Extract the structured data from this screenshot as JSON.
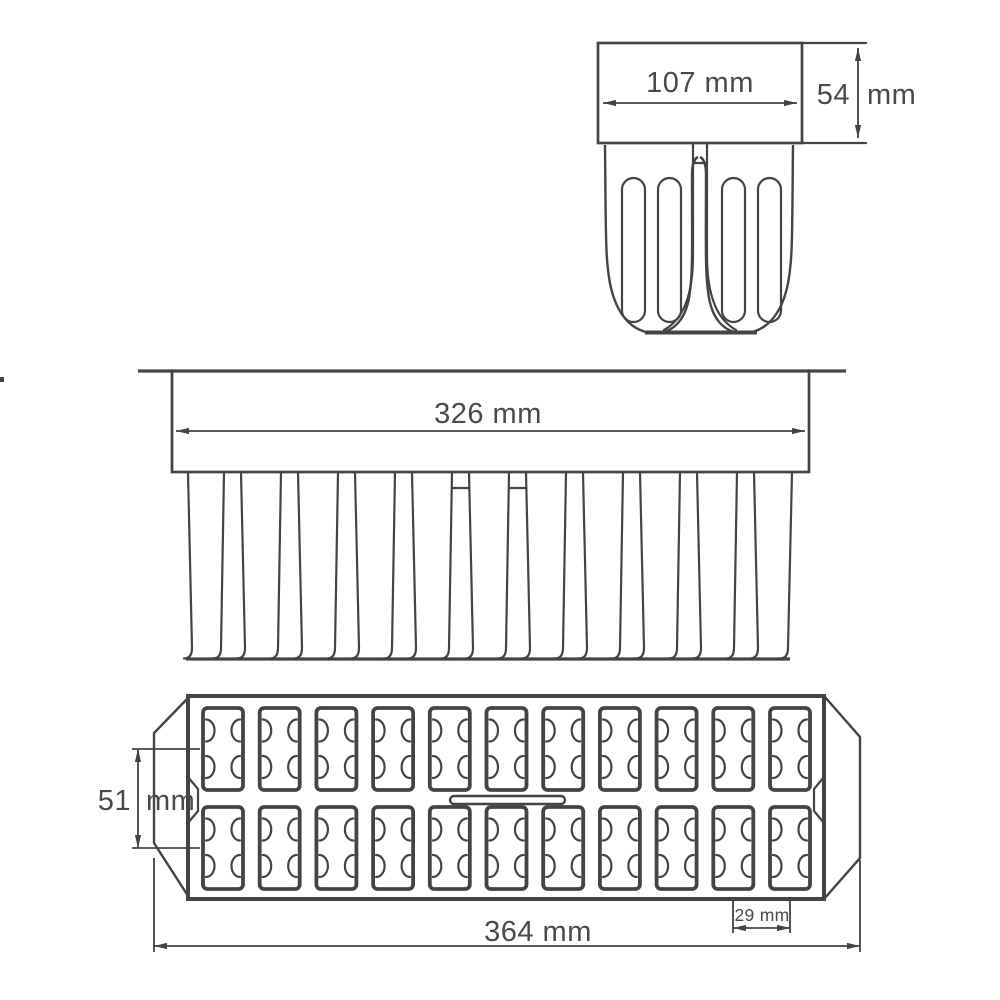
{
  "colors": {
    "line": "#444444",
    "text": "#4a4a4a",
    "background": "#ffffff"
  },
  "views": {
    "side": {
      "width_dim": "107 mm",
      "height_dim_value": "54",
      "height_dim_unit": "mm"
    },
    "front": {
      "width_dim": "326 mm"
    },
    "top": {
      "row_pitch_value": "51",
      "row_pitch_unit": "mm",
      "length_dim": "364 mm",
      "cavity_pitch_dim": "29 mm",
      "cavity_rows": 2,
      "cavity_columns": 11
    }
  }
}
